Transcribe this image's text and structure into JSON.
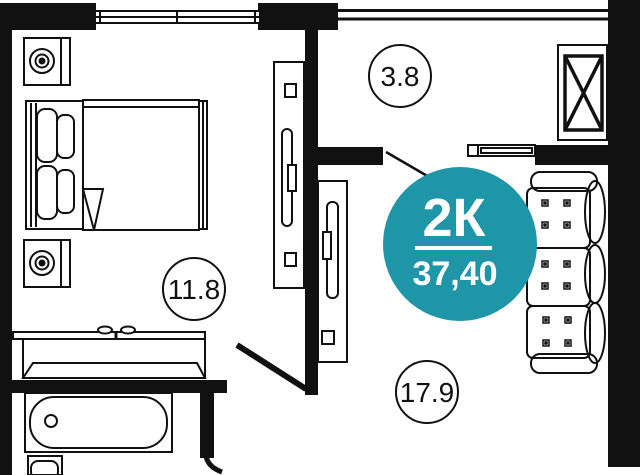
{
  "floor_plan": {
    "type_badge": {
      "label": "2К",
      "total_area": "37,40",
      "bg_color": "#1e96a8",
      "text_color": "#ffffff"
    },
    "rooms": [
      {
        "id": "hallway",
        "area": "3.8"
      },
      {
        "id": "bedroom",
        "area": "11.8"
      },
      {
        "id": "living_room",
        "area": "17.9"
      }
    ],
    "ink_color": "#111111",
    "background_color": "#ffffff"
  }
}
